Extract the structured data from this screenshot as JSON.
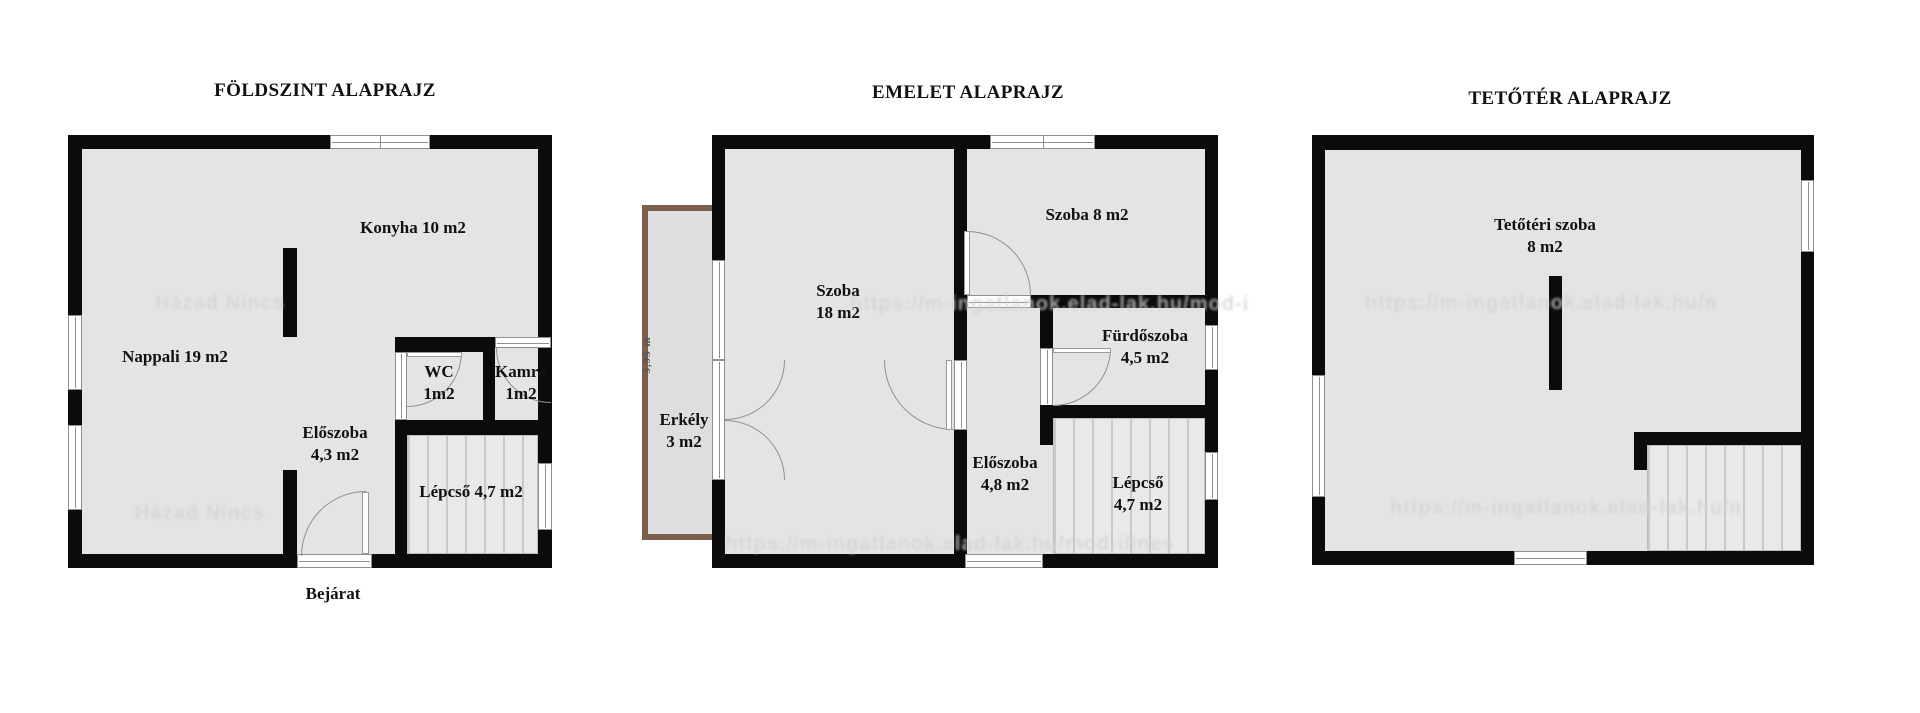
{
  "colors": {
    "wall": "#0b0b0b",
    "floor": "#e4e4e4",
    "frame": "#8f8f8f",
    "balcony": "#7d5f4d",
    "label": "#111111",
    "watermark": "#d2d2d2"
  },
  "ground": {
    "title": "FÖLDSZINT ALAPRAJZ",
    "labels": {
      "konyha": "Konyha 10 m2",
      "nappali": "Nappali 19 m2",
      "wc": "WC\n1m2",
      "kamra": "Kamra\n1m2",
      "eloszoba": "Előszoba\n4,3 m2",
      "lepcso": "Lépcső 4,7 m2",
      "bejarat": "Bejárat"
    }
  },
  "first": {
    "title": "EMELET ALAPRAJZ",
    "labels": {
      "szoba18": "Szoba\n18 m2",
      "szoba8": "Szoba 8 m2",
      "furdoszoba": "Fürdőszoba\n4,5 m2",
      "erkely": "Erkély\n3 m2",
      "eloszoba": "Előszoba\n4,8 m2",
      "lepcso": "Lépcső\n4,7 m2"
    },
    "balcony_dim": "3,95 m"
  },
  "attic": {
    "title": "TETŐTÉR ALAPRAJZ",
    "labels": {
      "szoba": "Tetőtéri szoba\n8 m2"
    }
  },
  "watermarks": {
    "brand": "Házad Nincs",
    "site": "https://m-ingatlanok.elad-lak.hu/mod-ilines"
  }
}
